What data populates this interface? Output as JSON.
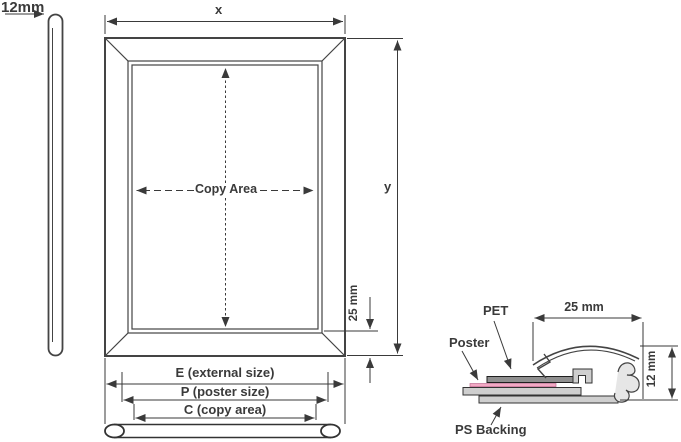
{
  "front_view": {
    "depth_label": "12mm",
    "width_label": "x",
    "height_label": "y",
    "copy_area_label": "Copy Area",
    "face_width_label": "25 mm",
    "external_size_label": "E (external size)",
    "poster_size_label": "P (poster size)",
    "copy_area_dim_label": "C (copy area)"
  },
  "section_view": {
    "pet_label": "PET",
    "poster_label": "Poster",
    "backing_label": "PS Backing",
    "profile_width_label": "25 mm",
    "profile_depth_label": "12 mm"
  },
  "colors": {
    "line": "#3a3a3a",
    "outline": "#444444",
    "fill_light": "#cfcfcf",
    "pet_fill": "#8f8f8f",
    "poster_pink": "#f2a9c4"
  }
}
